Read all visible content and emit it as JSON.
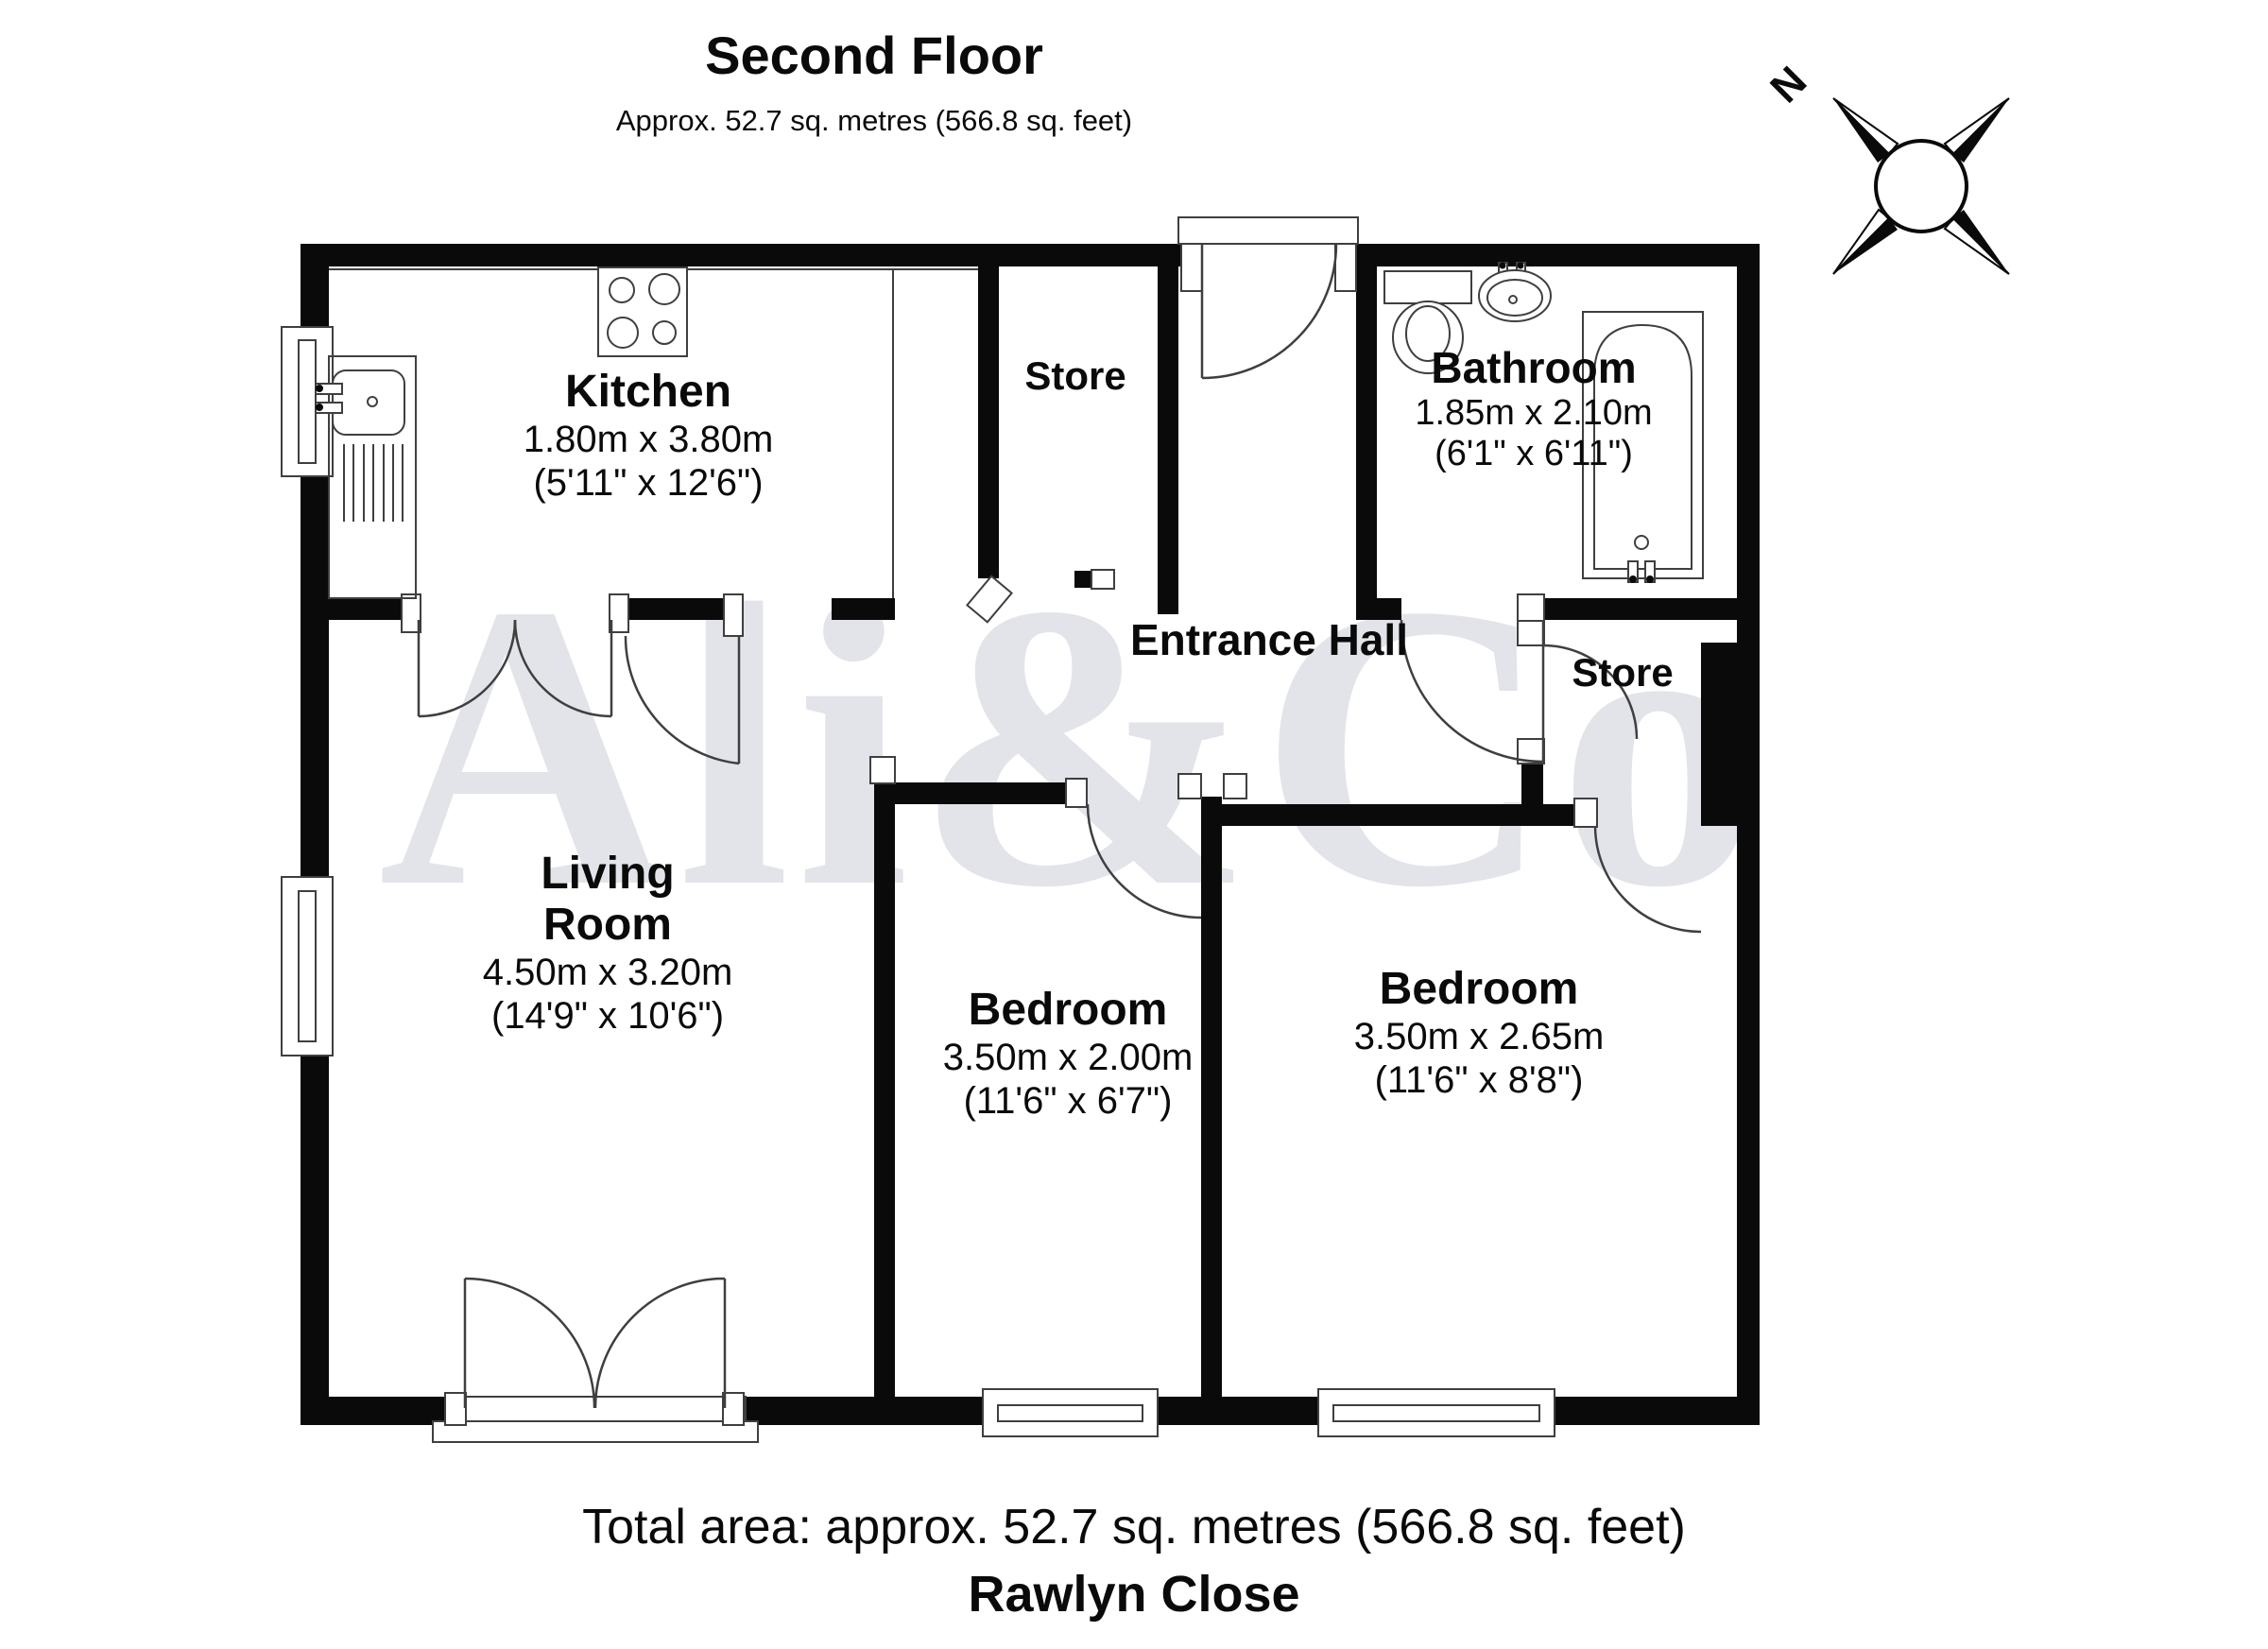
{
  "header": {
    "title": "Second Floor",
    "subtitle": "Approx. 52.7 sq. metres (566.8 sq. feet)"
  },
  "compass": {
    "north_label": "N"
  },
  "watermark": {
    "text": "Ali&Co"
  },
  "rooms": {
    "kitchen": {
      "name": "Kitchen",
      "metric": "1.80m x 3.80m",
      "imperial": "(5'11\" x 12'6\")"
    },
    "store_top": {
      "name": "Store"
    },
    "bathroom": {
      "name": "Bathroom",
      "metric": "1.85m x 2.10m",
      "imperial": "(6'1\" x 6'11\")"
    },
    "entrance_hall": {
      "name": "Entrance Hall"
    },
    "store_right": {
      "name": "Store"
    },
    "living_room": {
      "name": "Living Room",
      "metric": "4.50m x 3.20m",
      "imperial": "(14'9\" x 10'6\")"
    },
    "bedroom_left": {
      "name": "Bedroom",
      "metric": "3.50m x 2.00m",
      "imperial": "(11'6\" x 6'7\")"
    },
    "bedroom_right": {
      "name": "Bedroom",
      "metric": "3.50m x 2.65m",
      "imperial": "(11'6\" x 8'8\")"
    }
  },
  "footer": {
    "total_area": "Total area: approx. 52.7 sq. metres (566.8 sq. feet)",
    "address": "Rawlyn Close"
  },
  "colors": {
    "wall": "#0a0a0a",
    "line": "#3f3f3f",
    "watermark": "#e2e4ea",
    "background": "#ffffff"
  }
}
